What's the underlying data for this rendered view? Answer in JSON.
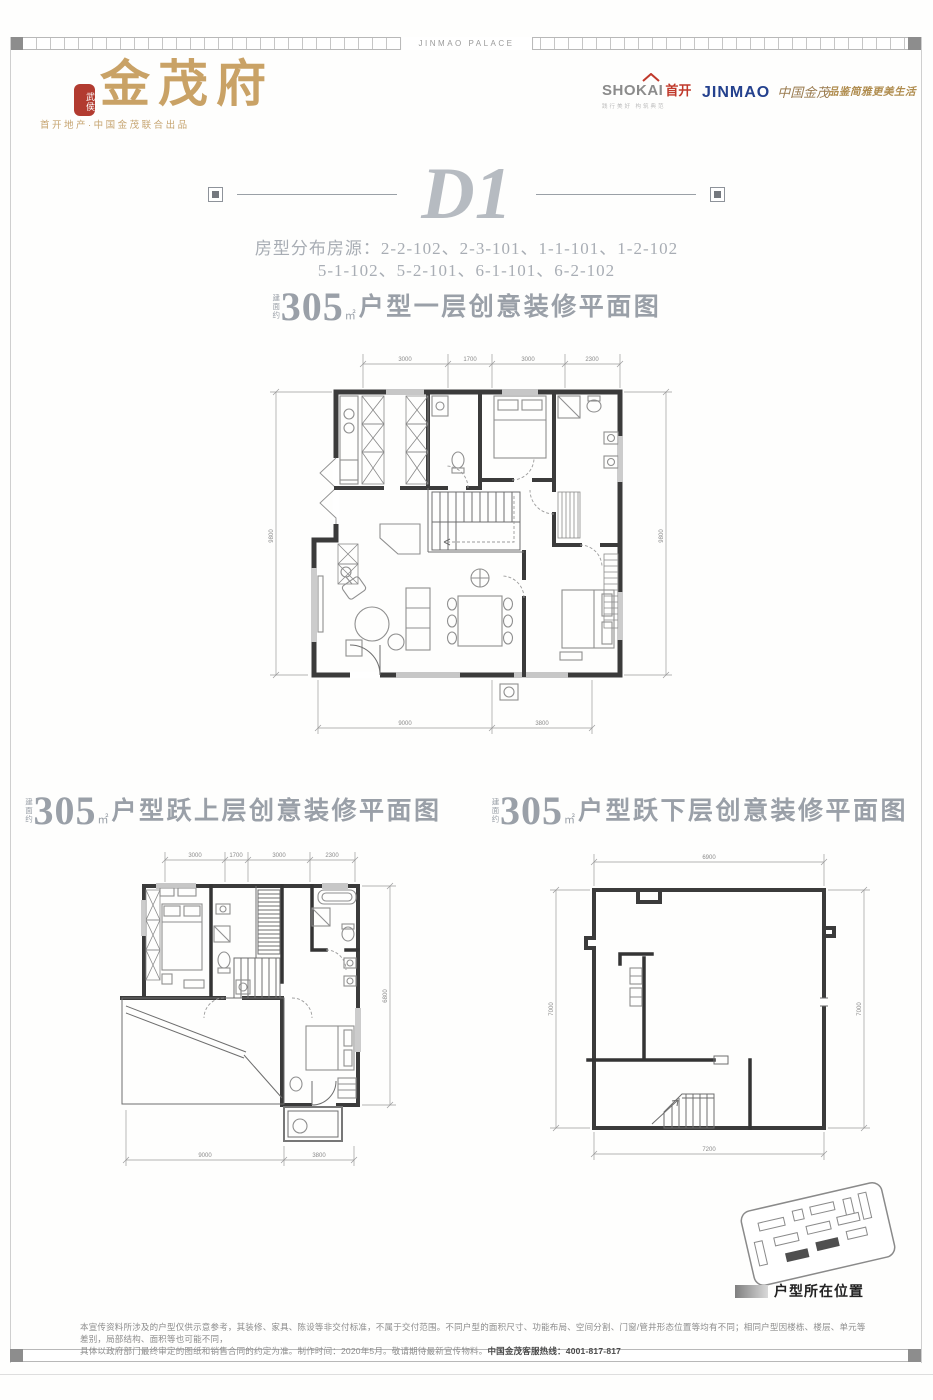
{
  "frame": {
    "top_label": "JINMAO PALACE"
  },
  "header": {
    "seal_text": "武侯",
    "brand": "金茂府",
    "subtitle": "首开地产·中国金茂联合出品",
    "shokai_latin": "SHOKAI",
    "shokai_cn": "首开",
    "shokai_tagline": "践行美好 构筑典范",
    "jinmao_latin": "JINMAO",
    "jinmao_cn": "中国金茂",
    "quality_tagline": "品鉴简雅更美生活"
  },
  "unit": {
    "title": "D1",
    "distribution_line1": "房型分布房源：2-2-102、2-3-101、1-1-101、1-2-102",
    "distribution_line2": "5-1-102、5-2-101、6-1-101、6-2-102"
  },
  "plans": {
    "level1": {
      "prefix": "建面约",
      "area": "305",
      "area_unit": "㎡",
      "title": "户型一层创意装修平面图",
      "dims_top": [
        "3000",
        "1700",
        "3000",
        "2300"
      ],
      "dims_bottom": [
        "9000",
        "3800"
      ],
      "dim_left": "9800",
      "dim_right": "9800"
    },
    "upper": {
      "prefix": "建面约",
      "area": "305",
      "area_unit": "㎡",
      "title": "户型跃上层创意装修平面图",
      "dims_top": [
        "3000",
        "1700",
        "3000",
        "2300"
      ],
      "dims_bottom": [
        "9000",
        "3800"
      ],
      "dim_right": "6800"
    },
    "lower": {
      "prefix": "建面约",
      "area": "305",
      "area_unit": "㎡",
      "title": "户型跃下层创意装修平面图",
      "dim_top": "6900",
      "dim_bottom": "7200",
      "dim_left": "7000",
      "dim_right": "7000"
    }
  },
  "siteplan": {
    "legend": "户型所在位置"
  },
  "disclaimer": {
    "line1": "本宣传资料所涉及的户型仅供示意参考，其装修、家具、陈设等非交付标准，不属于交付范围。不同户型的面积尺寸、功能布局、空间分割、门窗/管井形态位置等均有不同；相同户型因楼栋、楼层、单元等差别，局部结构、面积等也可能不同，",
    "line2_prefix": "具体以政府部门最终审定的图纸和销售合同的约定为准。制作时间：2020年5月。敬请期待最新宣传物料。",
    "hotline_label": "中国金茂客服热线：",
    "hotline_number": "4001-817-817"
  },
  "colors": {
    "gold": "#c9a266",
    "red": "#b23b30",
    "blue": "#24418e",
    "silver": "#9aa0a8"
  }
}
